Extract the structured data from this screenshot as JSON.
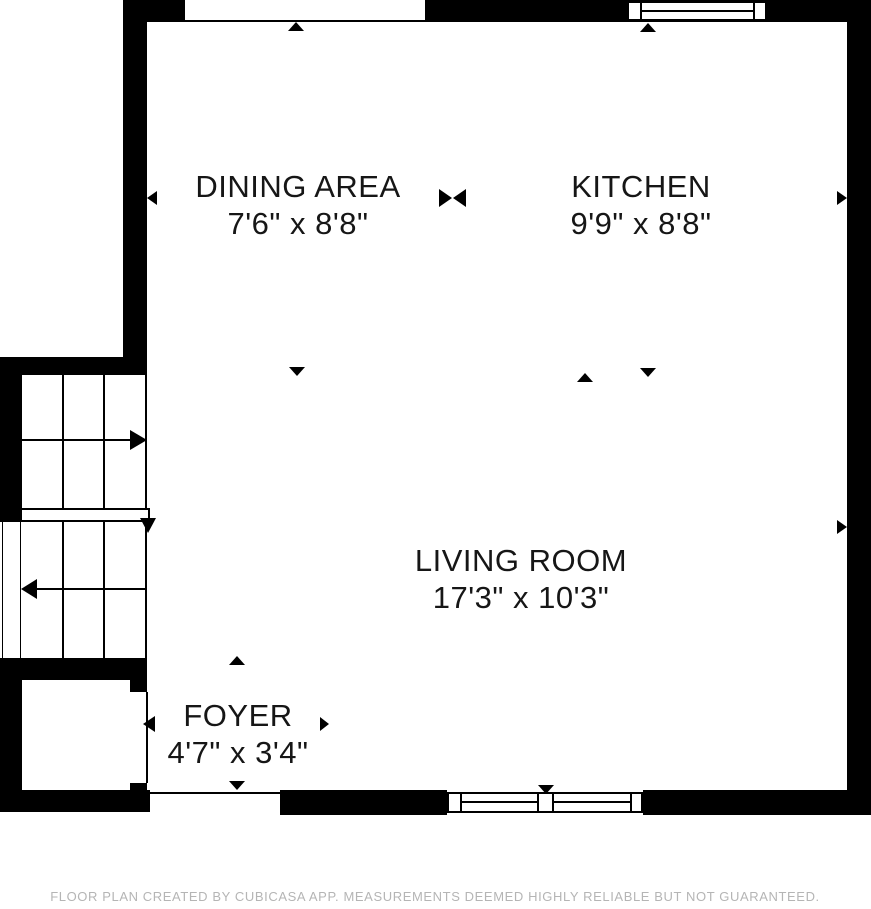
{
  "plan": {
    "rooms": [
      {
        "id": "dining-area",
        "name": "DINING AREA",
        "dimensions": "7'6\" x 8'8\""
      },
      {
        "id": "kitchen",
        "name": "KITCHEN",
        "dimensions": "9'9\" x 8'8\""
      },
      {
        "id": "living-room",
        "name": "LIVING ROOM",
        "dimensions": "17'3\" x 10'3\""
      },
      {
        "id": "foyer",
        "name": "FOYER",
        "dimensions": "4'7\" x 3'4\""
      }
    ],
    "features": {
      "windows": [
        "top-wall-window",
        "bottom-wall-double-window"
      ],
      "staircase": "two flights with landing, up arrow right, down arrow left",
      "markers": [
        "up-arrow top opening",
        "up-arrow below top window",
        "down-arrow dining to living",
        "up-arrow living room",
        "down-arrow kitchen to living",
        "room-divider bowtie dining/kitchen",
        "left-arrow left wall",
        "right-arrow right wall upper",
        "right-arrow right wall lower",
        "up-arrow foyer",
        "down-arrow foyer",
        "down-arrow above bottom window",
        "left-arrow closet door",
        "right-arrow foyer opening"
      ]
    },
    "footer": "FLOOR PLAN CREATED BY CUBICASA APP. MEASUREMENTS DEEMED HIGHLY RELIABLE BUT NOT GUARANTEED.",
    "colors": {
      "wall": "#000000",
      "background": "#ffffff",
      "footer_text": "#b5b5b5"
    }
  }
}
